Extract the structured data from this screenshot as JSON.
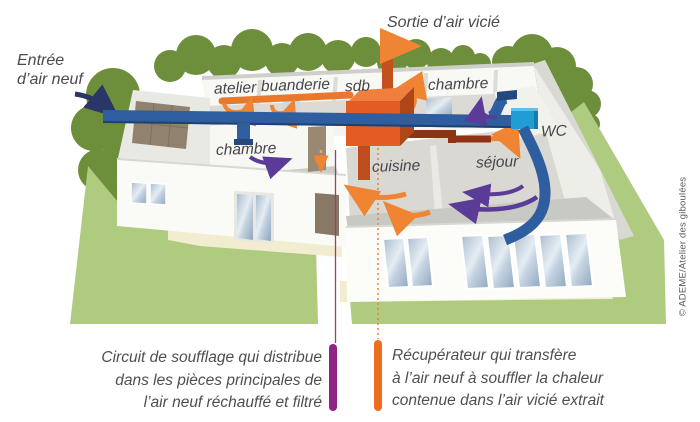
{
  "scene": {
    "air_inlet_label": {
      "line1": "Entrée",
      "line2": "d’air neuf"
    },
    "air_outlet_label": "Sortie d’air vicié",
    "rooms": {
      "atelier": "atelier",
      "buanderie": "buanderie",
      "sdb": "sdb",
      "chambre_back": "chambre",
      "chambre_front": "chambre",
      "cuisine": "cuisine",
      "sejour": "séjour",
      "wc": "WC"
    },
    "captions": {
      "circuit": {
        "lines": [
          "Circuit de soufflage qui distribue",
          "dans les pièces principales de",
          "l’air neuf réchauffé et filtré"
        ],
        "marker_color": "#8e2483"
      },
      "recuperateur": {
        "lines": [
          "Récupérateur qui transfère",
          "à l’air neuf à souffler la chaleur",
          "contenue dans l’air vicié extrait"
        ],
        "marker_color": "#ed6e1f"
      }
    },
    "credit": "© ADEME/Atelier des giboulées",
    "colors": {
      "fresh_air_blue": "#2e5e9f",
      "entry_arrow_navy": "#2b3668",
      "stale_air_purple": "#5a3b97",
      "supply_orange": "#ef8433",
      "exhaust_brown": "#8e3414",
      "unit_orange": "#e25c24",
      "wc_unit_blue": "#1f9dd4",
      "lawn_green": "#aecb80",
      "tree_green": "#6d8f3c",
      "path_beige": "#f2ecd0"
    }
  }
}
